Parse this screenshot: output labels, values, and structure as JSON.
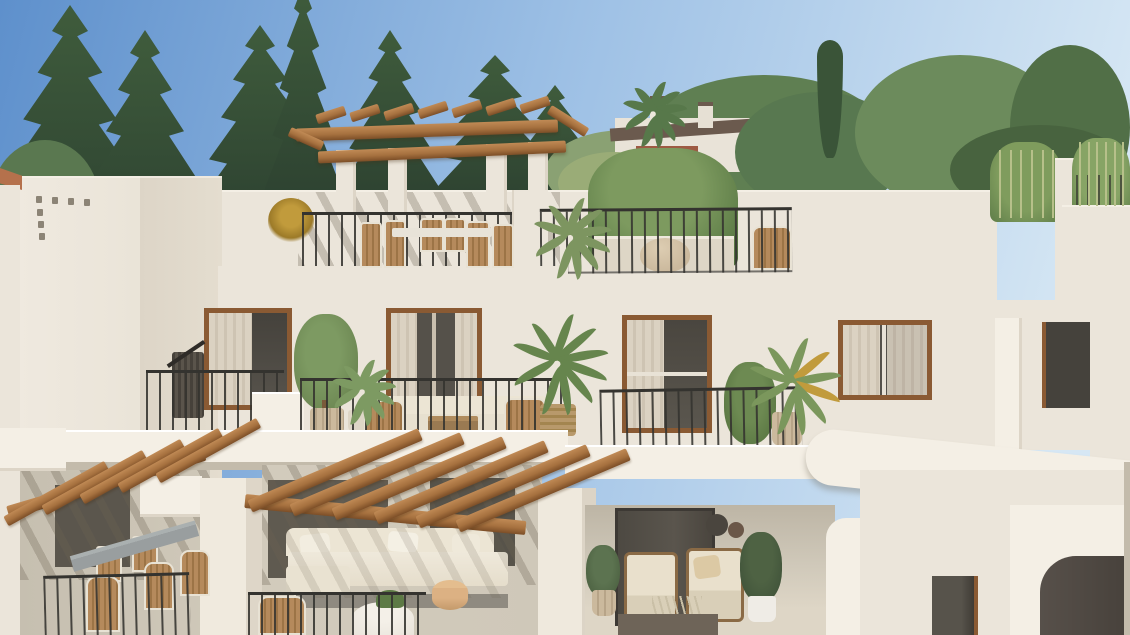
{
  "meta": {
    "title": "Architectural render of a white Mediterranean apartment building",
    "description": "Sunny 3D exterior render: white stucco multi-level apartments with wooden pergolas, black iron balcony railings, terrace furniture and Mediterranean pines behind",
    "visible_text": "none",
    "lighting": "bright daylight, sun from upper left casting diagonal pergola shadows"
  },
  "colors": {
    "sky-top": "#5e90cc",
    "sky-mid": "#9dc0e5",
    "sky-low": "#d6e7f4",
    "conifer-dark": "#2c4030",
    "conifer-mid": "#3f5c3c",
    "conifer-light": "#5a7850",
    "pine-green": "#5f7f52",
    "pine-light": "#8aa173",
    "olive-leaf": "#9aac77",
    "cypress": "#3a5438",
    "wall-bright": "#f4efe5",
    "wall": "#ebe5da",
    "wall-shade": "#ddd5c7",
    "wall-dark": "#c3bbab",
    "recess": "#cfc8b9",
    "wood-light": "#c08a55",
    "wood": "#a6713f",
    "wood-dark": "#7c4e27",
    "frame-brown": "#8a5a33",
    "glass": "#55514a",
    "glass-dark": "#45423c",
    "curtain": "#dbd2c2",
    "railing": "#34332f",
    "cream": "#ece5d4",
    "cushion": "#e9e0cc",
    "sofa-base": "#8f8a80",
    "wicker": "#c0a478",
    "rattan": "#b58a5c",
    "pot-beige": "#cbb99d",
    "pot-white": "#efece6",
    "planter": "#ded6c6",
    "leaf": "#6b8a52",
    "leaf-dark": "#47603c",
    "leaf-bright": "#7d9a62",
    "yellow-flower": "#c19b3c",
    "stool": "#dcb183",
    "table-gray": "#999e9f",
    "dark-table": "#6e6458",
    "terracotta": "#b5714c",
    "house-roof": "#6b5a4e",
    "awning-red": "#9e5a43",
    "teal": "#4e8f8a"
  },
  "scene": {
    "background": [
      "blue sky",
      "dark conifer trees left",
      "soft pine and olive trees right",
      "narrow cypress",
      "distant white villa with chimneys and palm tree"
    ],
    "rooftop": [
      "white stair tower with vent holes",
      "wooden pergola on white pillars",
      "rattan dining set behind iron railing",
      "yellow dried flowers",
      "large planter bush",
      "palm plants",
      "bamboo screen right"
    ],
    "middle_floor": [
      "four brown-framed windows with curtains",
      "juliet balcony",
      "terrace with white sofa, wicker chairs, coffee table, olive tree and palms in pots"
    ],
    "ground_floor": [
      "two wooden beam pergolas",
      "grey dining table with wicker chairs",
      "large cream sectional sofa with wooden stool",
      "covered patio with two cream armchairs, plants and wall plates",
      "curved white walls with arch and small dark window"
    ]
  }
}
